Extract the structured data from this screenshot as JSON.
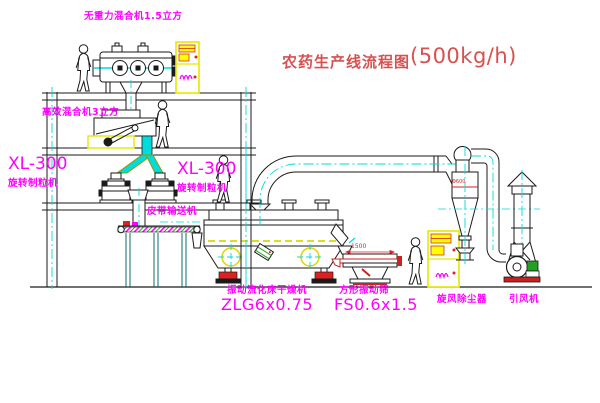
{
  "title": {
    "text_cn": "农药生产线流程图",
    "capacity": "(500kg/h)"
  },
  "equipment_labels": {
    "gravity_mixer": "无重力混合机1.5立方",
    "high_eff_mixer": "高效混合机3立方",
    "granulator_left": {
      "model": "XL-300",
      "name": "旋转制粒机"
    },
    "granulator_right": {
      "model": "XL-300",
      "name": "旋转制粒机"
    },
    "belt_conveyor": "皮带输送机",
    "fluid_bed_dryer": {
      "name": "振动流化床干燥机",
      "model": "ZLG6x0.75"
    },
    "vibrating_screen": {
      "name": "方形振动筛",
      "model": "FS0.6x1.5"
    },
    "cyclone": "旋风除尘器",
    "fan": "引风机"
  },
  "dimensions": {
    "screen_length": "1500",
    "cyclone_dia": "Φ600"
  },
  "colors": {
    "label_magenta": "#ff00ff",
    "title_red": "#d95050",
    "line_black": "#1a1a1a",
    "centerline_cyan": "#00dcdc",
    "cabinet_yellow": "#e8e800",
    "accent_red": "#e02020",
    "motor_green": "#22a022"
  }
}
